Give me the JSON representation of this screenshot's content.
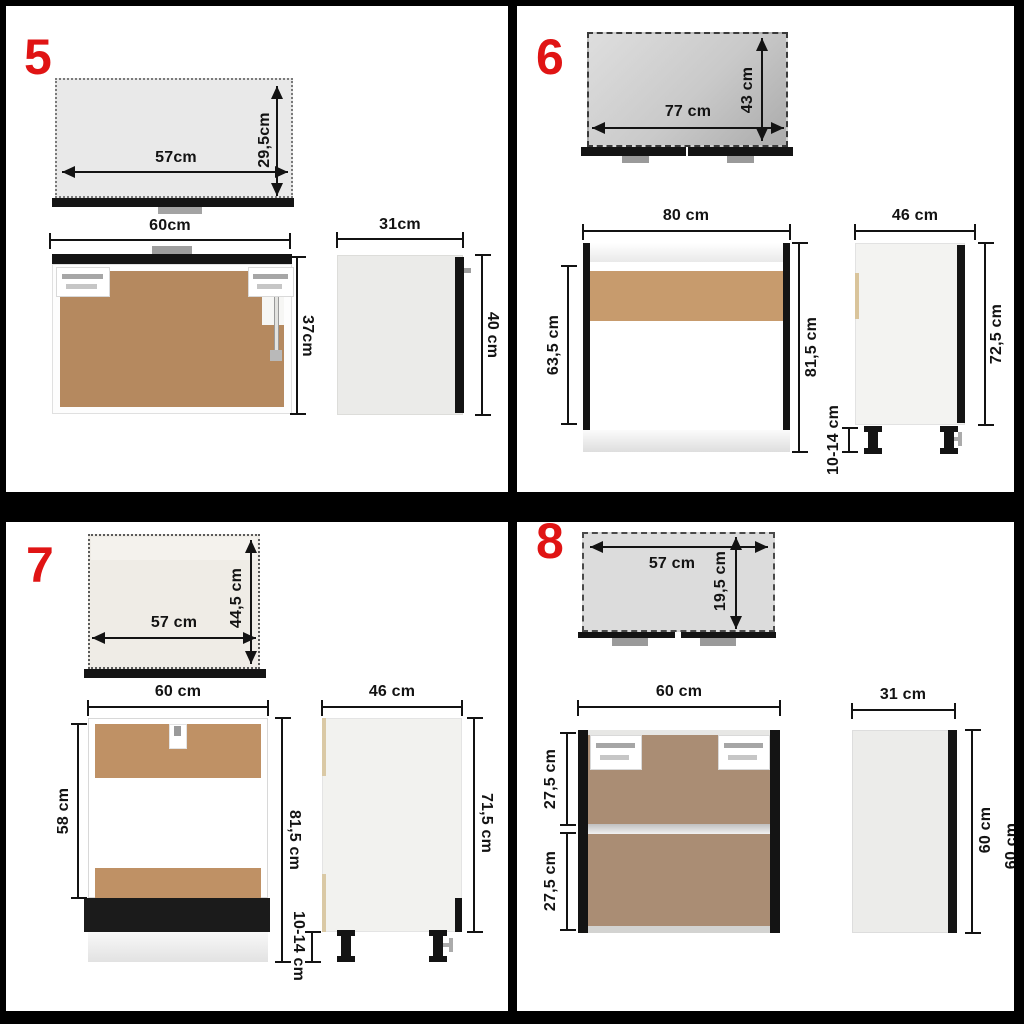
{
  "colors": {
    "accent_red": "#e01414",
    "cabinet_black": "#141414",
    "hardboard_brown": "#b5895f",
    "hardboard_light_brown": "#c79b6d",
    "hardboard_taupe": "#aa8d74",
    "dim_line": "#131313",
    "top_view_gray": "#dcdcdc"
  },
  "panels": [
    {
      "number": "5",
      "top_view": {
        "width_label": "57cm",
        "depth_label": "29,5cm"
      },
      "front_view": {
        "width_label": "60cm",
        "height_label": "37cm"
      },
      "side_view": {
        "depth_label": "31cm",
        "height_label": "40 cm"
      }
    },
    {
      "number": "6",
      "top_view": {
        "width_label": "77 cm",
        "depth_label": "43 cm"
      },
      "front_view": {
        "width_label": "80 cm",
        "interior_height_label": "63,5 cm",
        "height_label": "81,5 cm"
      },
      "side_view": {
        "depth_label": "46 cm",
        "height_label": "72,5 cm",
        "leg_height_label": "10-14 cm"
      }
    },
    {
      "number": "7",
      "top_view": {
        "width_label": "57 cm",
        "depth_label": "44,5 cm"
      },
      "front_view": {
        "width_label": "60 cm",
        "interior_height_label": "58 cm",
        "height_label": "81,5 cm"
      },
      "side_view": {
        "depth_label": "46 cm",
        "height_label": "71,5 cm",
        "leg_height_label": "10-14 cm"
      }
    },
    {
      "number": "8",
      "top_view": {
        "width_label": "57 cm",
        "depth_label": "19,5 cm"
      },
      "front_view": {
        "width_label": "60 cm",
        "upper_section_label": "27,5 cm",
        "lower_section_label": "27,5 cm"
      },
      "side_view": {
        "depth_label": "31 cm",
        "height_label": "60 cm",
        "height_label_clipped": "60 cm"
      }
    }
  ]
}
